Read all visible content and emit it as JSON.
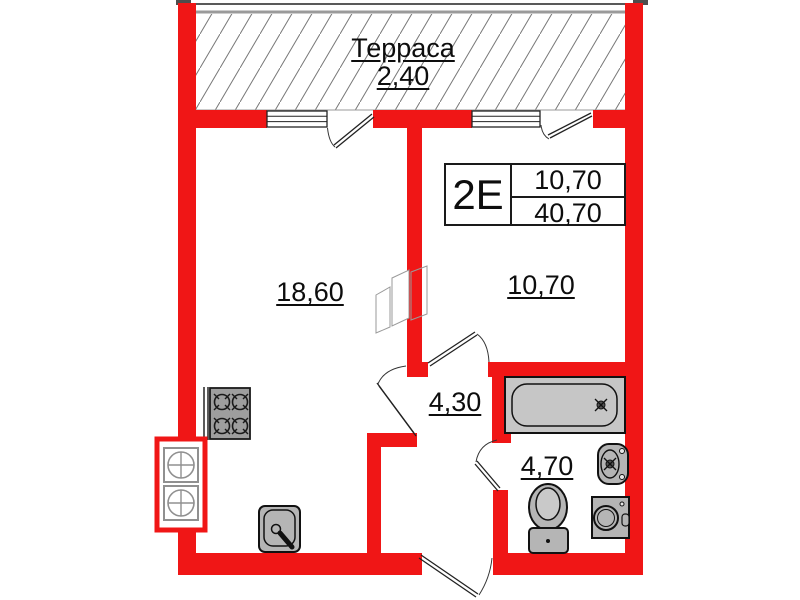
{
  "colors": {
    "wall": "#f01616",
    "fixture": "#b5b5b5",
    "stove": "#9e9e9e",
    "tub": "#c6c6c6",
    "hatch_line": "#787878"
  },
  "terrace": {
    "name": "Терраса",
    "area": "2,40"
  },
  "unit_card": {
    "type": "2E",
    "upper_area": "10,70",
    "total_area": "40,70"
  },
  "rooms": {
    "living": {
      "area": "18,60"
    },
    "bedroom": {
      "area": "10,70"
    },
    "hall": {
      "area": "4,30"
    },
    "bathroom": {
      "area": "4,70"
    }
  },
  "fixtures": [
    "stove",
    "vent-shafts",
    "kitchen-sink",
    "duct-sketch",
    "bathtub",
    "washbasin",
    "toilet",
    "washing-machine"
  ]
}
